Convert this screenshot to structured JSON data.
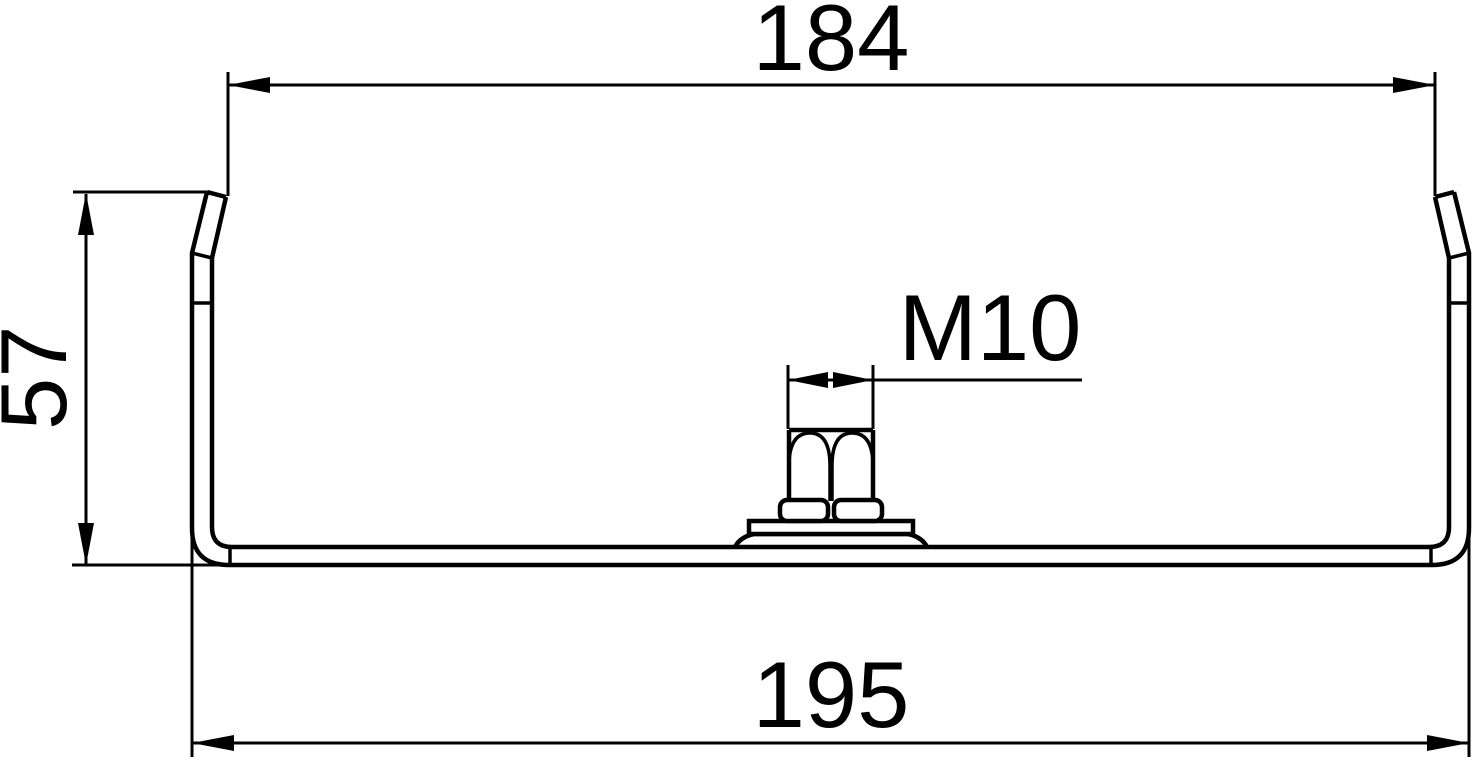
{
  "drawing": {
    "kind": "technical-cross-section",
    "dimensions": {
      "inner_top_width": "184",
      "height": "57",
      "outer_bottom_width": "195",
      "thread": "M10"
    }
  },
  "colors": {
    "line": "#000000",
    "background": "#ffffff"
  }
}
